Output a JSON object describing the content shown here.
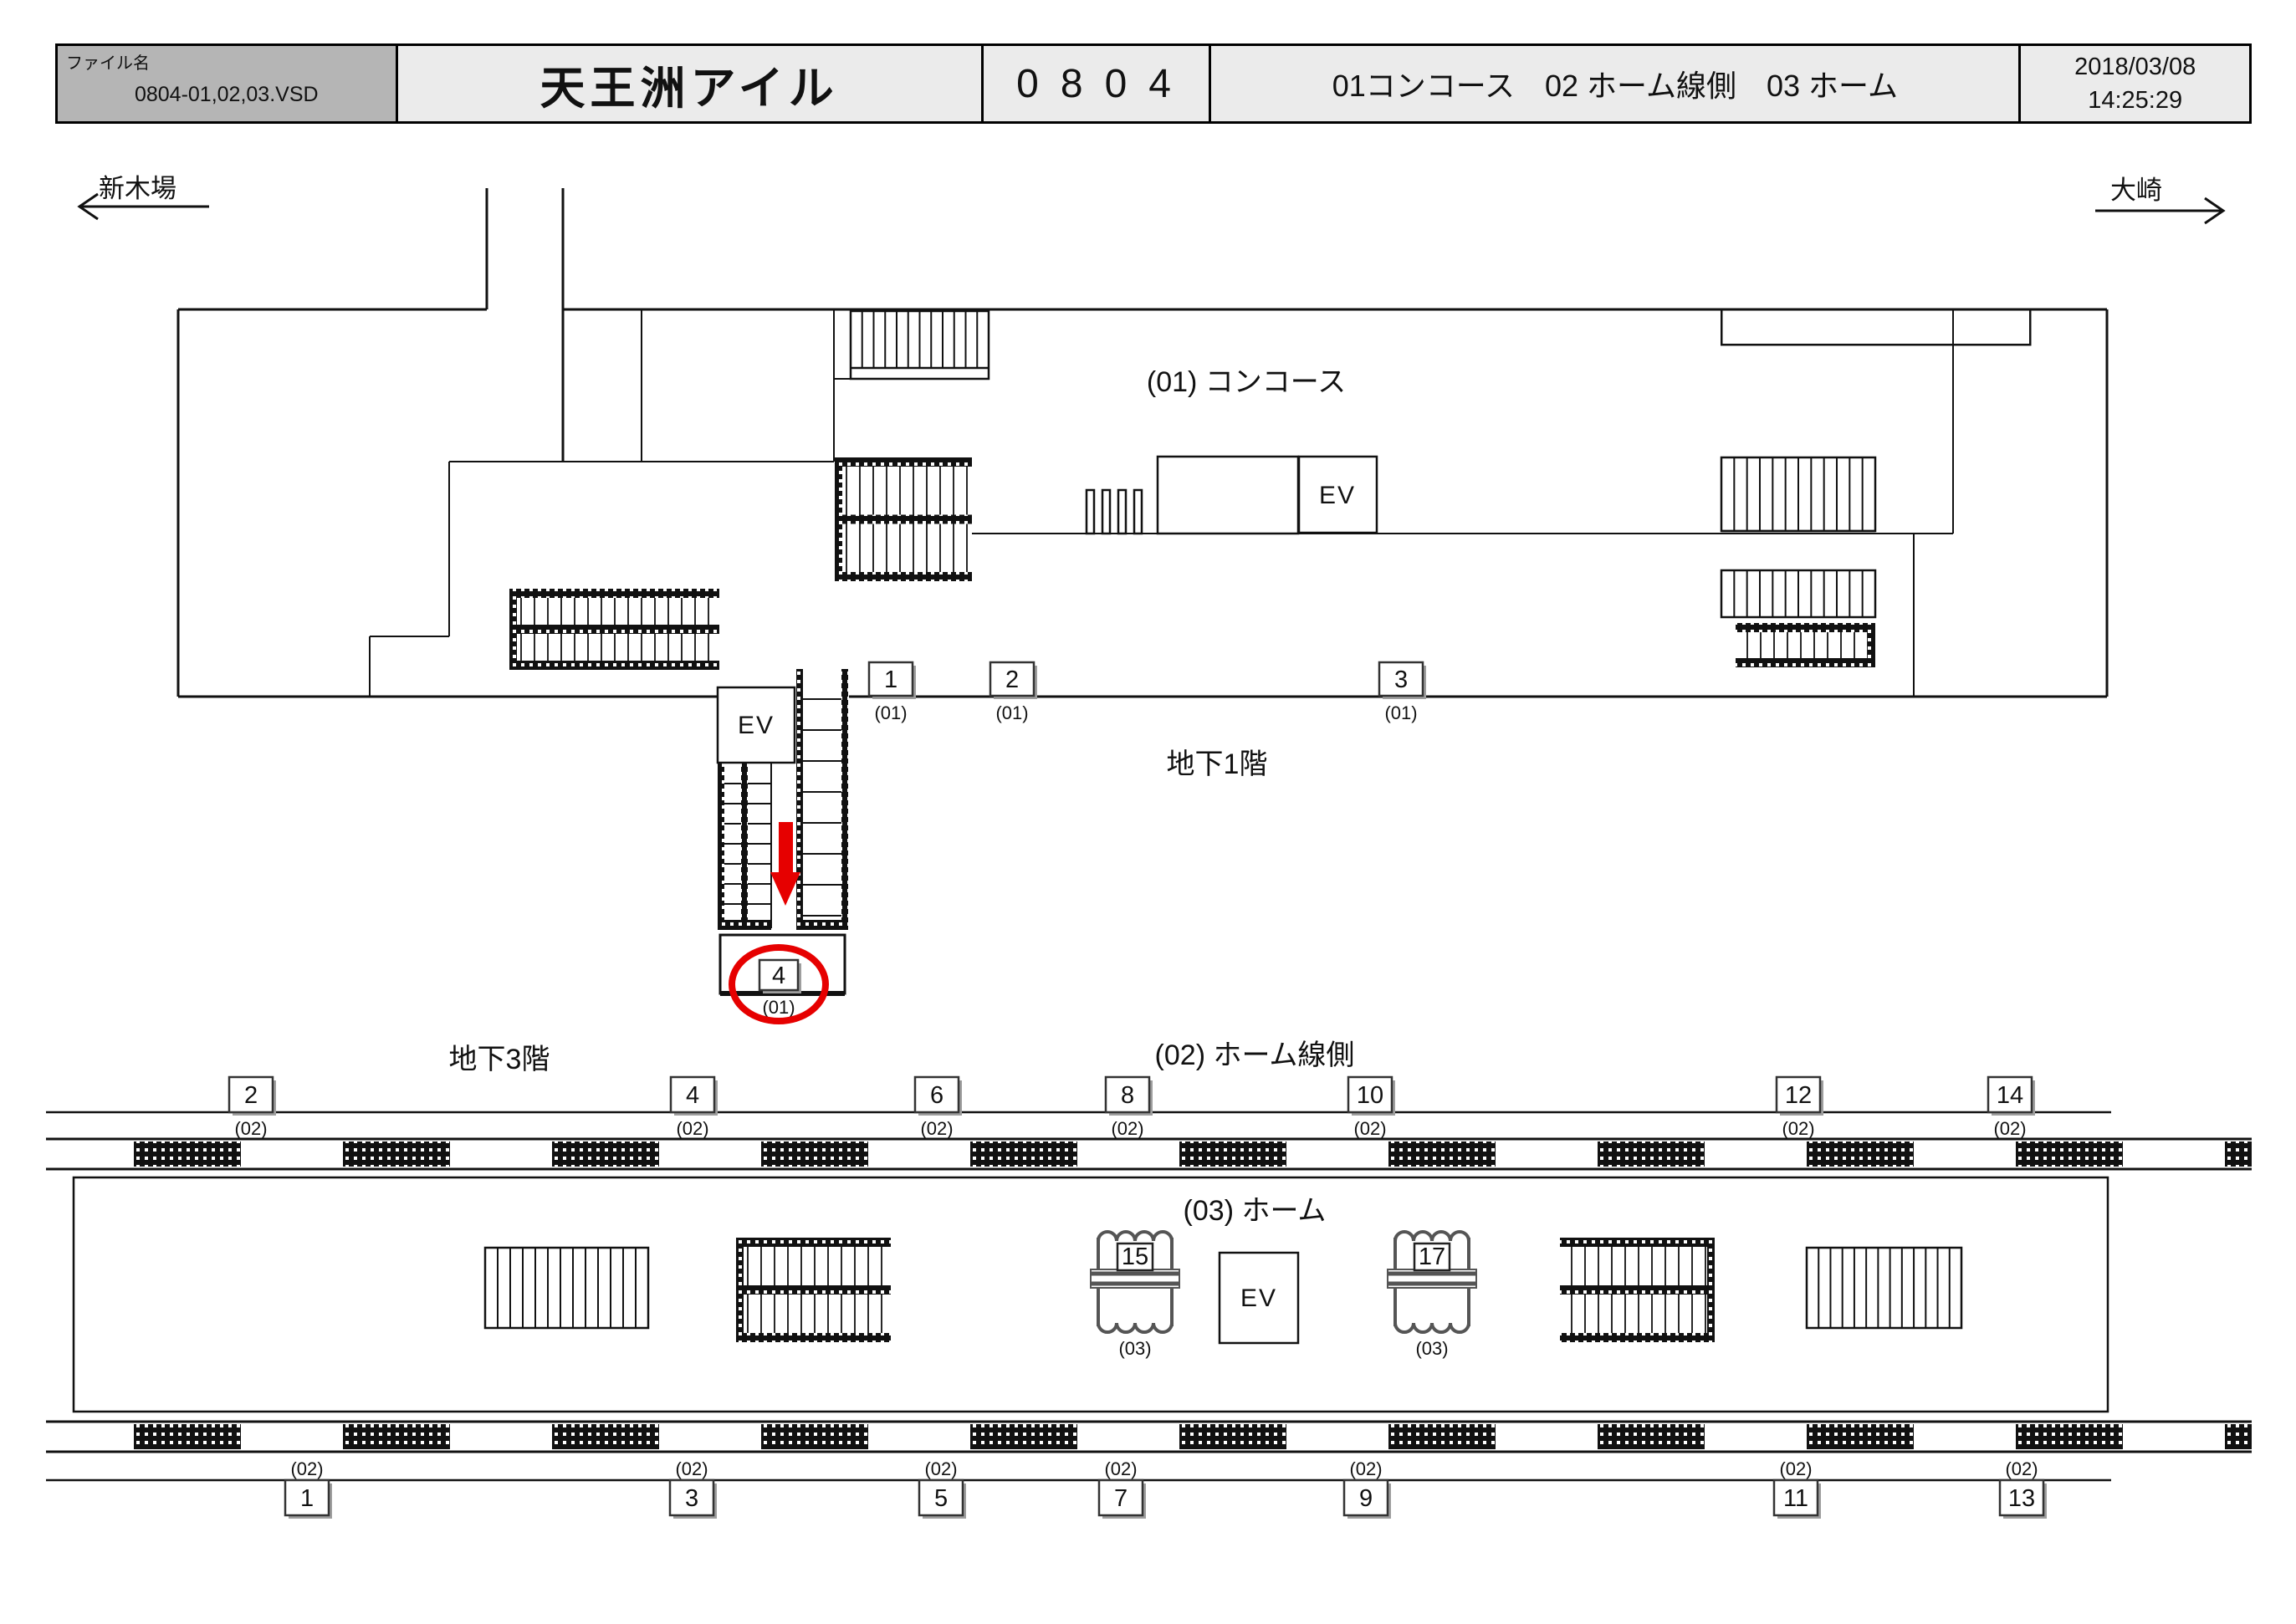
{
  "header": {
    "filename_label": "ファイル名",
    "filename": "0804-01,02,03.VSD",
    "station_name": "天王洲アイル",
    "station_code": "0804",
    "categories": "01コンコース　02 ホーム線側　03 ホーム",
    "date": "2018/03/08",
    "time": "14:25:29"
  },
  "directions": {
    "left": "新木場",
    "right": "大崎"
  },
  "labels": {
    "concourse": "(01) コンコース",
    "b1": "地下1階",
    "b3": "地下3階",
    "track_side": "(02) ホーム線側",
    "platform": "(03) ホーム",
    "ev": "EV"
  },
  "colors": {
    "highlight": "#e60000",
    "line": "#111111"
  },
  "markers": {
    "concourse": [
      {
        "num": "1",
        "floor": "(01)"
      },
      {
        "num": "2",
        "floor": "(01)"
      },
      {
        "num": "3",
        "floor": "(01)"
      },
      {
        "num": "4",
        "floor": "(01)"
      }
    ],
    "track_upper": [
      {
        "num": "2",
        "floor": "(02)"
      },
      {
        "num": "4",
        "floor": "(02)"
      },
      {
        "num": "6",
        "floor": "(02)"
      },
      {
        "num": "8",
        "floor": "(02)"
      },
      {
        "num": "10",
        "floor": "(02)"
      },
      {
        "num": "12",
        "floor": "(02)"
      },
      {
        "num": "14",
        "floor": "(02)"
      }
    ],
    "track_lower": [
      {
        "num": "1",
        "floor": "(02)"
      },
      {
        "num": "3",
        "floor": "(02)"
      },
      {
        "num": "5",
        "floor": "(02)"
      },
      {
        "num": "7",
        "floor": "(02)"
      },
      {
        "num": "9",
        "floor": "(02)"
      },
      {
        "num": "11",
        "floor": "(02)"
      },
      {
        "num": "13",
        "floor": "(02)"
      }
    ],
    "platform_pillars": [
      {
        "num": "15",
        "floor": "(03)"
      },
      {
        "num": "17",
        "floor": "(03)"
      }
    ]
  }
}
